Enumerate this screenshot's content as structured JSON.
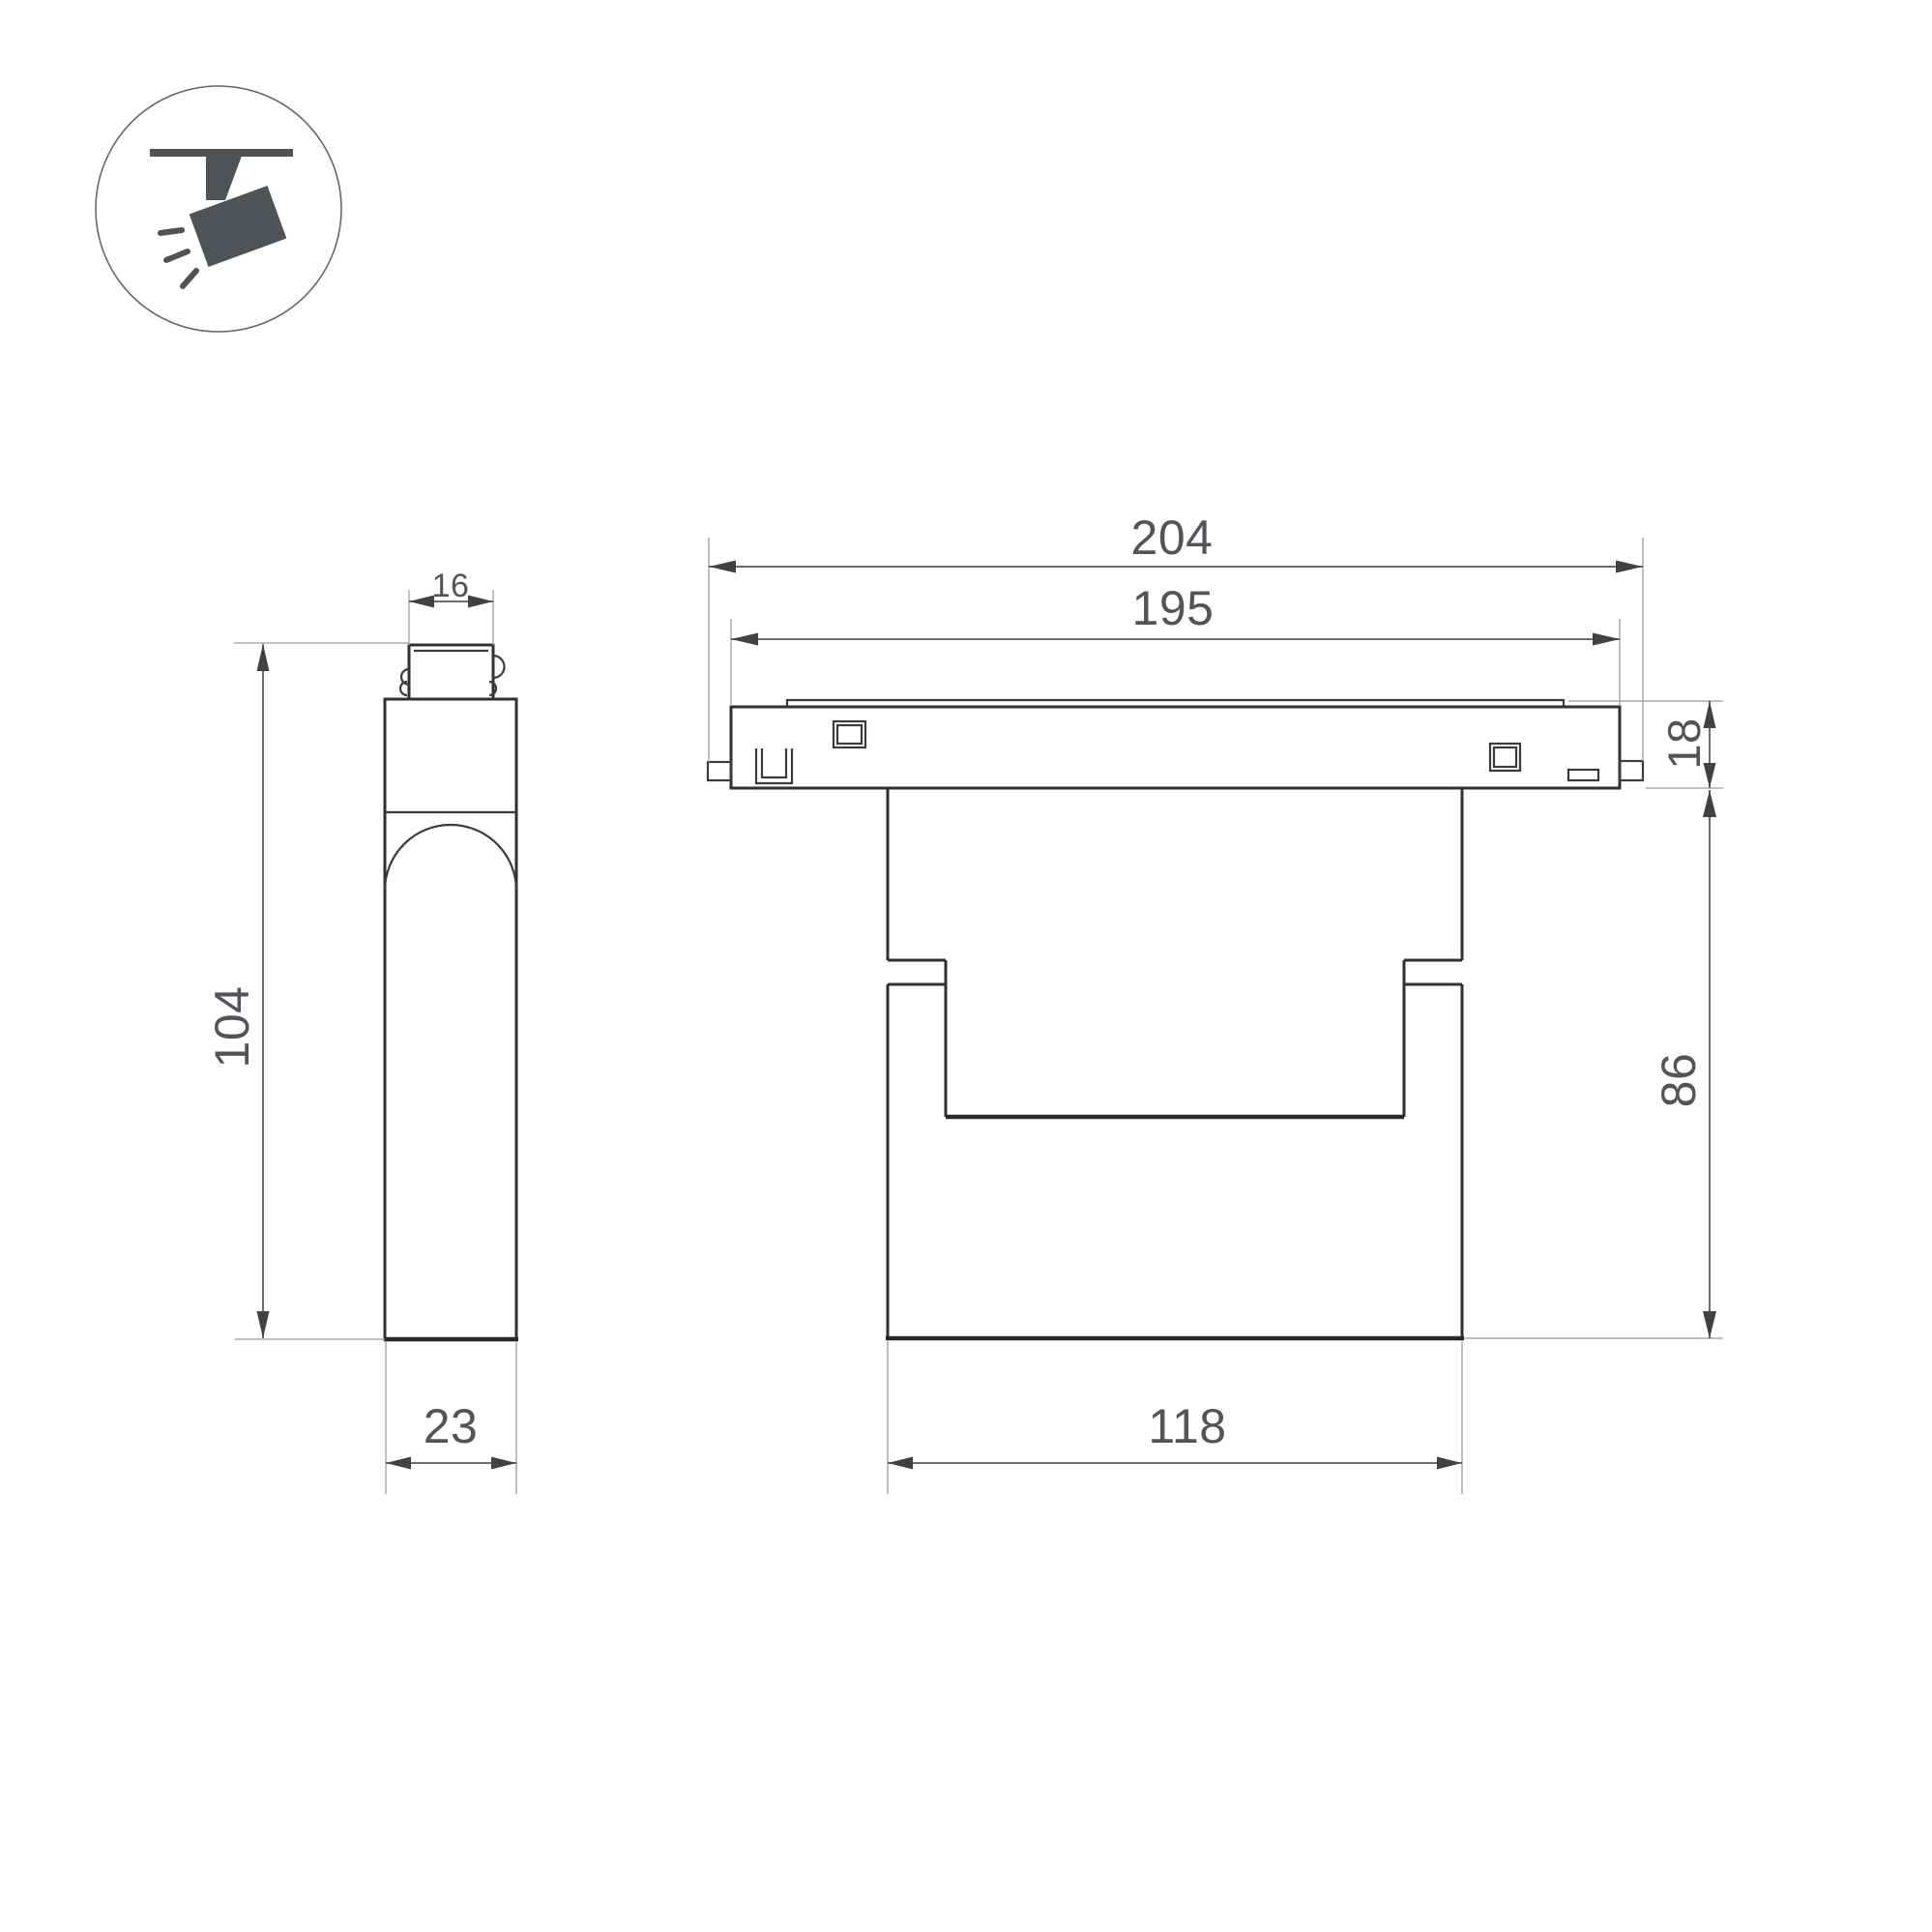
{
  "title": "Magnetic track spotlight — dimensional drawing",
  "legend_icon": {
    "meaning": "ceiling track-mounted spotlight",
    "color": "#4d5357"
  },
  "colors": {
    "background": "#ffffff",
    "object_outline": "#2f3033",
    "dimension_line": "#56585b",
    "extension_line": "#aaacae",
    "dimension_text": "#515459"
  },
  "views": {
    "side_view": {
      "name": "side view (left)"
    },
    "front_view": {
      "name": "front view (right)"
    }
  },
  "dimensions": {
    "connector_width": "16",
    "fixture_height": "104",
    "base_depth": "23",
    "overall_length": "204",
    "track_length": "195",
    "track_height": "18",
    "body_height": "86",
    "body_width": "118"
  }
}
